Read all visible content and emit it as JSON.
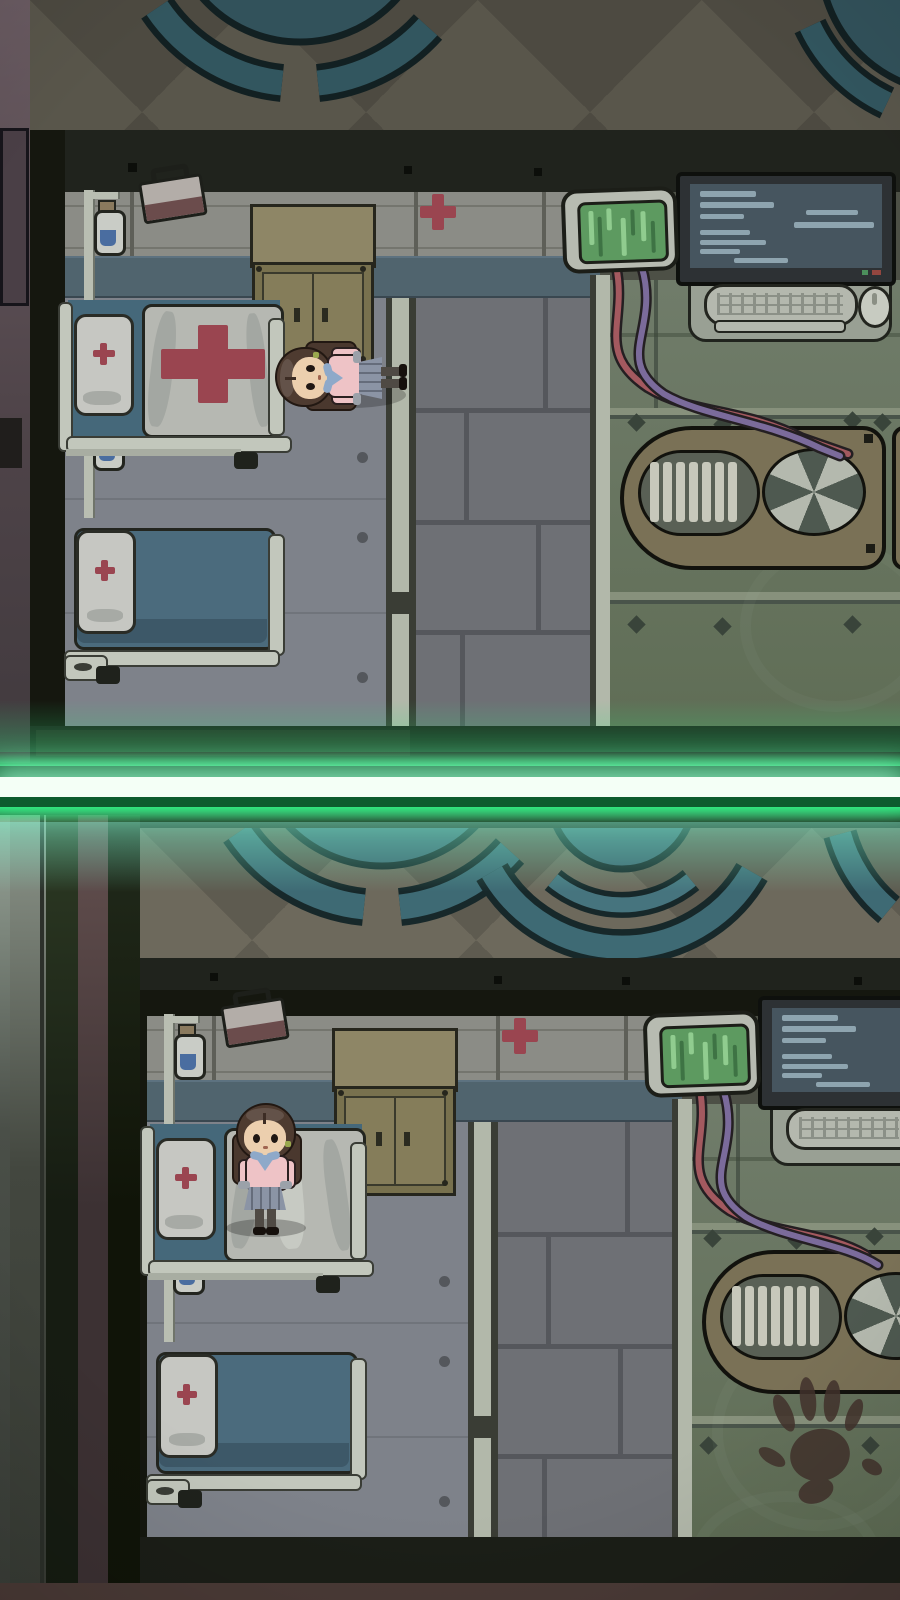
{
  "meta": {
    "title": "top-down pixel-art hospital horror game — split view",
    "view": "two near-identical hospital ward scenes stacked vertically, separated by a glowing green laser beam",
    "resolution": {
      "width": 900,
      "height": 1600
    },
    "visible_text": "none"
  },
  "palette": {
    "laser-green": "#2fe57d",
    "laser-core": "#f4fff6",
    "wall-teal": "#50646e",
    "cross-red": "#9a4550",
    "screen-green": "#5d9a60",
    "screen-blue": "#46555f",
    "machine-brown": "#7a7156",
    "cabinet-tan": "#8e8666",
    "bed-blue": "#4b6b7d",
    "outfit-pink": "#eec3c6",
    "scarf-blue": "#8ea9c9",
    "cable-red": "#a3595f",
    "cable-purple": "#7b6b9b",
    "teal-disc": "#3d6470",
    "blood-brown": "#42322c"
  },
  "divider": {
    "type": "glowing-laser-beam",
    "orientation": "horizontal",
    "description": "white-hot core with green glow spanning full width"
  },
  "panels": [
    {
      "id": "top",
      "character": {
        "name": "schoolgirl",
        "pose": "lying on bedroom floor",
        "outfit": "pink sweater, blue neckerchief, gray skirt, pigtails"
      },
      "rooms": [
        "upper hall with checkered floor and round ceiling lamp",
        "ward bedroom with two beds",
        "brick corridor",
        "green machine room"
      ],
      "objects": [
        "iv-drip-stand with two bags",
        "first-aid-kit",
        "medicine-cabinet",
        "wall red cross",
        "hospital-bed with red-cross blanket",
        "hospital-bed with blue blanket",
        "green vital monitor",
        "computer workstation with keyboard and mouse",
        "red and purple cables",
        "ventilation machine with fan"
      ]
    },
    {
      "id": "bottom",
      "character": {
        "name": "schoolgirl",
        "pose": "standing on hospital bed",
        "outfit": "pink sweater, blue neckerchief, gray skirt, pigtails"
      },
      "rooms": [
        "upper hall with checkered floor and round ceiling lamp",
        "ward bedroom with two beds",
        "brick corridor",
        "green machine room"
      ],
      "objects": [
        "iv-drip-stand with two bags",
        "first-aid-kit",
        "medicine-cabinet",
        "wall red cross",
        "hospital-bed with crumpled white sheet",
        "hospital-bed with blue blanket",
        "green vital monitor",
        "computer workstation with keyboard",
        "red and purple cables",
        "ventilation machine with fan",
        "bloody handprint on floor"
      ]
    }
  ]
}
